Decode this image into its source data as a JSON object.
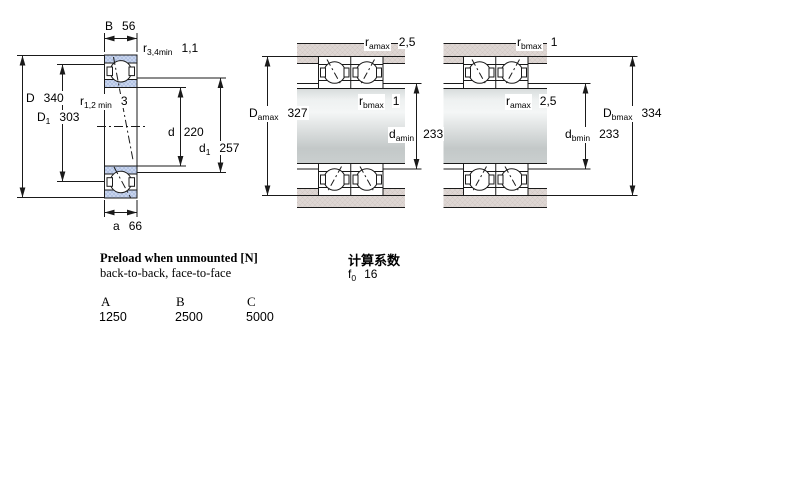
{
  "labels": {
    "B": {
      "base": "B",
      "value": "56"
    },
    "r34": {
      "base": "r",
      "sub": "3,4min",
      "value": "1,1"
    },
    "D": {
      "base": "D",
      "value": "340"
    },
    "D1": {
      "base": "D",
      "sub": "1",
      "value": "303"
    },
    "r12": {
      "base": "r",
      "sub": "1,2 min",
      "value": "3"
    },
    "d": {
      "base": "d",
      "value": "220"
    },
    "d1": {
      "base": "d",
      "sub": "1",
      "value": "257"
    },
    "a": {
      "base": "a",
      "value": "66"
    },
    "mid_r_top": {
      "base": "r",
      "sub": "amax",
      "value": "2,5"
    },
    "mid_r_inner": {
      "base": "r",
      "sub": "bmax",
      "value": "1"
    },
    "mid_D": {
      "base": "D",
      "sub": "amax",
      "value": "327"
    },
    "mid_d": {
      "base": "d",
      "sub": "amin",
      "value": "233"
    },
    "right_r_top": {
      "base": "r",
      "sub": "bmax",
      "value": "1"
    },
    "right_r_inner": {
      "base": "r",
      "sub": "amax",
      "value": "2,5"
    },
    "right_D": {
      "base": "D",
      "sub": "bmax",
      "value": "334"
    },
    "right_d": {
      "base": "d",
      "sub": "bmin",
      "value": "233"
    }
  },
  "preload": {
    "title": "Preload when unmounted [N]",
    "subtitle": "back-to-back, face-to-face",
    "headers": [
      "A",
      "B",
      "C"
    ],
    "values": [
      "1250",
      "2500",
      "5000"
    ]
  },
  "calc": {
    "title": "计算系数",
    "f0_base": "f",
    "f0_sub": "0",
    "f0_value": "16"
  },
  "colors": {
    "line": "#1a1a1a",
    "ring_fill": "#ccd8ef",
    "ring_hatch": "#a9bbdf",
    "housing_fill": "#ded6d3",
    "housing_hatch": "#cfc5c2",
    "shaft_mid_gray": "#c3c8c8"
  }
}
